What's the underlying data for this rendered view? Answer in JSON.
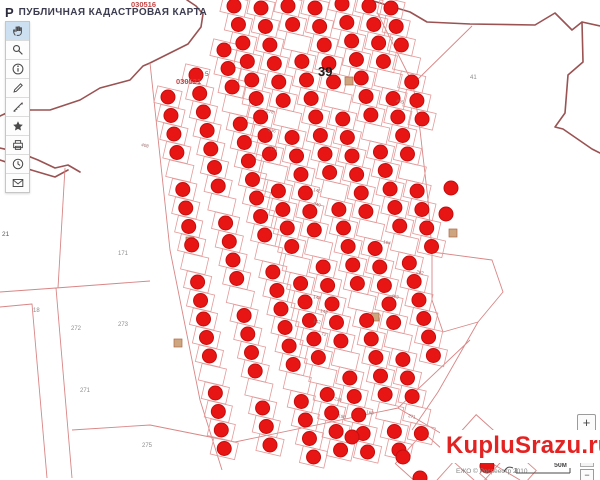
{
  "header": {
    "title": "ПУБЛИЧНАЯ КАДАСТРОВАЯ КАРТА",
    "logo_glyph": "Р"
  },
  "toolbar": {
    "tools": [
      {
        "name": "pan",
        "active": true
      },
      {
        "name": "search",
        "active": false
      },
      {
        "name": "info",
        "active": false
      },
      {
        "name": "draw",
        "active": false
      },
      {
        "name": "measure",
        "active": false
      },
      {
        "name": "favorites",
        "active": false
      },
      {
        "name": "print",
        "active": false
      },
      {
        "name": "history",
        "active": false
      },
      {
        "name": "feedback",
        "active": false
      }
    ]
  },
  "zoom_control": {
    "plus_label": "+",
    "minus_label": "−"
  },
  "watermark": {
    "text": "KupluSrazu.ru",
    "color": "#e32222"
  },
  "attribution": {
    "text": "ЕЖО © Росреестр 2010",
    "scale_label": "50м"
  },
  "map": {
    "colors": {
      "dot": "#e81515",
      "boundary_dark": "#9a5252",
      "parcel_line": "#e49a9a"
    },
    "cell": {
      "w": 25,
      "h": 17,
      "rot": 13
    },
    "dot_radius": 7,
    "step": 18.5,
    "columns": [
      {
        "x": 168,
        "y": 97,
        "slope": 0.16,
        "count": 20,
        "skip": [
          4,
          9,
          15
        ]
      },
      {
        "x": 196,
        "y": 75,
        "slope": 0.2,
        "count": 21,
        "skip": [
          7,
          12,
          17
        ]
      },
      {
        "x": 224,
        "y": 50,
        "slope": 0.22,
        "count": 23,
        "skip": [
          3,
          11,
          18
        ]
      },
      {
        "x": 234,
        "y": 6,
        "slope": 0.24,
        "count": 25,
        "skip": [
          9,
          14,
          20
        ]
      },
      {
        "x": 261,
        "y": 8,
        "slope": 0.24,
        "count": 25,
        "skip": [
          6,
          13,
          19
        ]
      },
      {
        "x": 288,
        "y": 6,
        "slope": 0.25,
        "count": 25,
        "skip": [
          2,
          10,
          16,
          22
        ]
      },
      {
        "x": 315,
        "y": 8,
        "slope": 0.25,
        "count": 24,
        "skip": [
          5,
          12,
          18,
          22
        ]
      },
      {
        "x": 342,
        "y": 4,
        "slope": 0.26,
        "count": 20,
        "skip": [
          7,
          13
        ]
      },
      {
        "x": 369,
        "y": 6,
        "slope": 0.26,
        "count": 14,
        "skip": [
          4,
          9
        ]
      },
      {
        "x": 391,
        "y": 8,
        "slope": 0.28,
        "count": 7,
        "skip": [
          3
        ]
      }
    ],
    "extra_dots": [
      [
        403,
        457
      ],
      [
        487,
        466
      ],
      [
        420,
        478
      ],
      [
        352,
        437
      ],
      [
        446,
        214
      ],
      [
        451,
        188
      ]
    ],
    "buildings": [
      [
        349,
        81
      ],
      [
        453,
        233
      ],
      [
        190,
        241
      ],
      [
        375,
        317
      ],
      [
        178,
        343
      ]
    ],
    "diamonds": [
      {
        "cx": 425,
        "cy": 462,
        "size": 42,
        "rot": 42
      },
      {
        "cx": 478,
        "cy": 450,
        "size": 50,
        "rot": 42
      },
      {
        "cx": 508,
        "cy": 472,
        "size": 40,
        "rot": 42
      }
    ],
    "boundaries": [
      {
        "cls": "bdark",
        "points": "187,0 196,6 203,14 201,27 188,44 150,63 143,66 130,80 100,88 80,100 50,110 13,110 0,116"
      },
      {
        "cls": "bdark",
        "points": "0,148 18,152 38,160 55,168 68,165 80,172"
      },
      {
        "cls": "bdark",
        "points": "0,160 18,166 38,172 55,177 68,170"
      },
      {
        "cls": "bdark",
        "points": "370,0 410,12 427,22 470,24 535,25 555,13 572,30 582,22 600,26"
      },
      {
        "cls": "bdark",
        "points": "582,22 583,62 568,75 565,113 555,127 563,129 592,149 600,153"
      },
      {
        "cls": "bline",
        "points": "150,63 170,250 200,400 222,470"
      },
      {
        "cls": "bline",
        "points": "377,12 413,84 420,130 428,200 432,252"
      },
      {
        "cls": "bline",
        "points": "413,84 472,26"
      },
      {
        "cls": "bline",
        "points": "0,292 56,288 72,478"
      },
      {
        "cls": "bline",
        "points": "0,307 32,304 47,478"
      },
      {
        "cls": "bline",
        "points": "56,288 150,281"
      },
      {
        "cls": "bline",
        "points": "65,168 58,288"
      },
      {
        "cls": "bline",
        "points": "72,430 150,425 235,442"
      },
      {
        "cls": "bline",
        "points": "235,442 398,408 470,340"
      },
      {
        "cls": "bline",
        "points": "398,408 520,480"
      },
      {
        "cls": "bline",
        "points": "432,252 492,260 503,292 478,322 443,332 432,300 432,252"
      },
      {
        "cls": "bline",
        "points": "478,322 438,392 412,430"
      }
    ],
    "labels": [
      {
        "x": 131,
        "y": 7,
        "text": "030516",
        "cls": "lq"
      },
      {
        "x": 176,
        "y": 84,
        "text": "030521",
        "cls": "lq"
      },
      {
        "x": 318,
        "y": 76,
        "text": "39",
        "cls": "l39"
      },
      {
        "x": 205,
        "y": 76,
        "text": "5",
        "cls": "ldark"
      },
      {
        "x": 2,
        "y": 236,
        "text": "21",
        "cls": "ldark"
      },
      {
        "x": 118,
        "y": 255,
        "text": "171",
        "cls": "lbig"
      },
      {
        "x": 33,
        "y": 312,
        "text": "18",
        "cls": "lbig"
      },
      {
        "x": 71,
        "y": 330,
        "text": "272",
        "cls": "lbig"
      },
      {
        "x": 118,
        "y": 326,
        "text": "273",
        "cls": "lbig"
      },
      {
        "x": 80,
        "y": 392,
        "text": "271",
        "cls": "lbig"
      },
      {
        "x": 142,
        "y": 447,
        "text": "275",
        "cls": "lbig"
      },
      {
        "x": 470,
        "y": 79,
        "text": "41",
        "cls": "lbig"
      },
      {
        "x": 396,
        "y": 102,
        "text": "405",
        "cls": "ltiny",
        "rot": 13
      },
      {
        "x": 266,
        "y": 112,
        "text": "278",
        "cls": "ltiny",
        "rot": 13
      },
      {
        "x": 268,
        "y": 131,
        "text": "236",
        "cls": "ltiny",
        "rot": 13
      },
      {
        "x": 270,
        "y": 149,
        "text": "121",
        "cls": "ltiny",
        "rot": 13
      },
      {
        "x": 141,
        "y": 146,
        "text": "408",
        "cls": "ltiny",
        "rot": 13
      },
      {
        "x": 313,
        "y": 191,
        "text": "145",
        "cls": "ltiny",
        "rot": 13
      },
      {
        "x": 313,
        "y": 205,
        "text": "240",
        "cls": "ltiny",
        "rot": 13
      },
      {
        "x": 383,
        "y": 243,
        "text": "104",
        "cls": "ltiny",
        "rot": 13
      },
      {
        "x": 416,
        "y": 273,
        "text": "282",
        "cls": "ltiny",
        "rot": 13
      },
      {
        "x": 313,
        "y": 298,
        "text": "144",
        "cls": "ltiny",
        "rot": 13
      },
      {
        "x": 320,
        "y": 312,
        "text": "143",
        "cls": "ltiny",
        "rot": 13
      },
      {
        "x": 313,
        "y": 322,
        "text": "142",
        "cls": "ltiny",
        "rot": 13
      },
      {
        "x": 321,
        "y": 335,
        "text": "72",
        "cls": "ltiny",
        "rot": 13
      },
      {
        "x": 391,
        "y": 297,
        "text": "403",
        "cls": "ltiny",
        "rot": 13
      },
      {
        "x": 334,
        "y": 400,
        "text": "228",
        "cls": "ltiny",
        "rot": 13
      },
      {
        "x": 338,
        "y": 417,
        "text": "198",
        "cls": "ltiny",
        "rot": 13
      },
      {
        "x": 366,
        "y": 413,
        "text": "168",
        "cls": "ltiny",
        "rot": 13
      },
      {
        "x": 408,
        "y": 417,
        "text": "271",
        "cls": "ltiny",
        "rot": 13
      }
    ]
  }
}
